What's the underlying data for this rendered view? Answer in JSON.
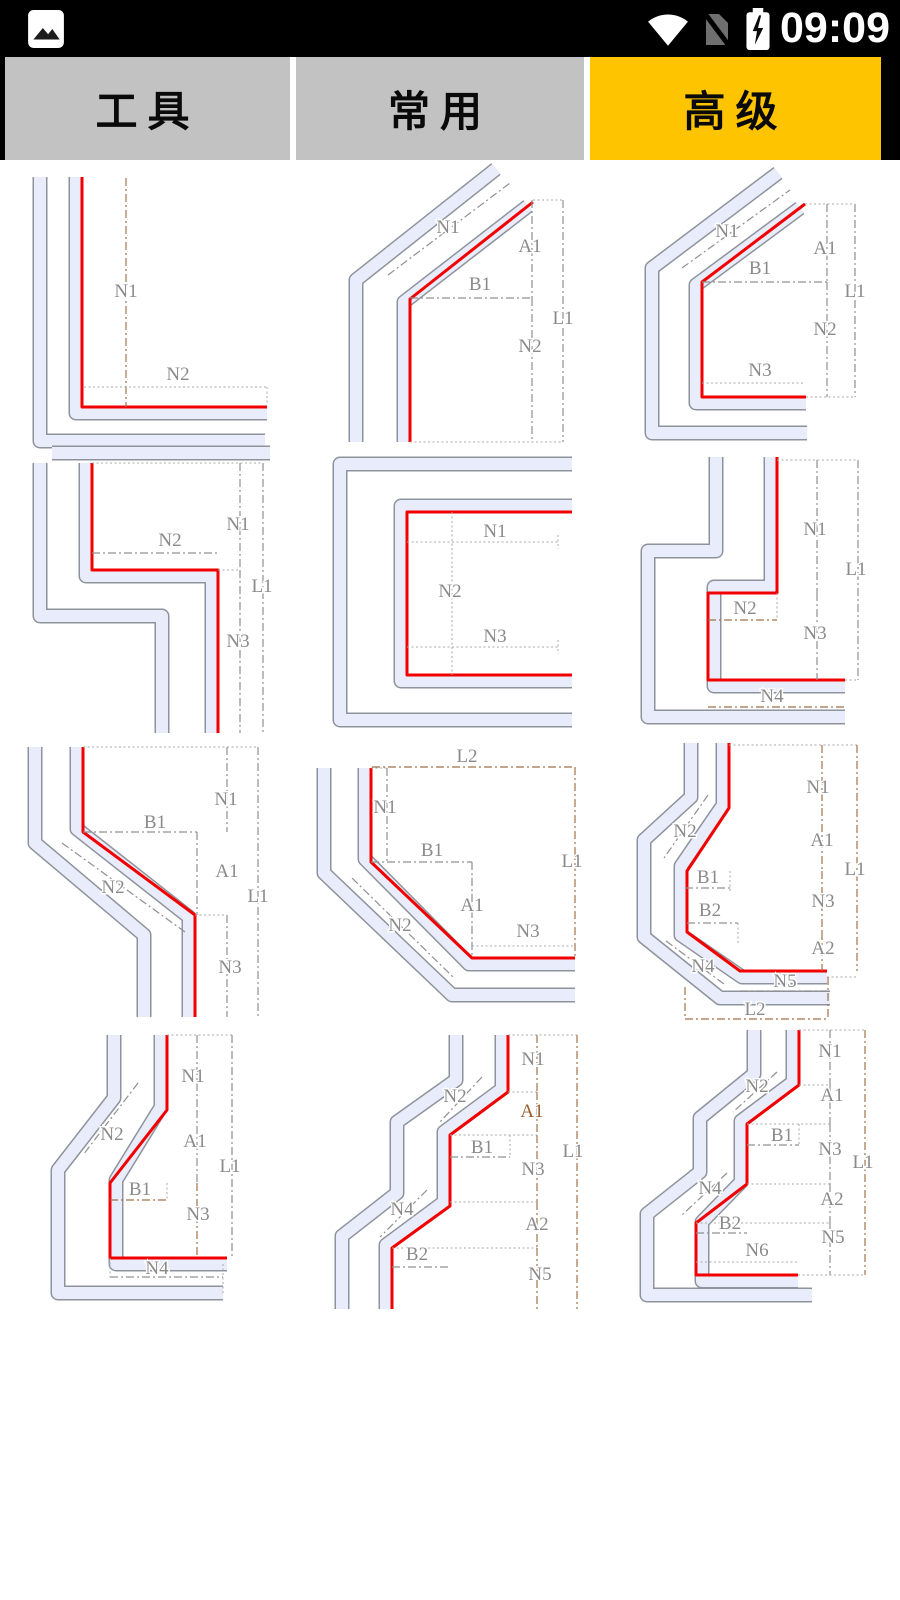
{
  "status_bar": {
    "time": "09:09",
    "icons": [
      "photo-icon",
      "wifi-icon",
      "no-sim-icon",
      "battery-charging-icon"
    ]
  },
  "tabs": [
    {
      "label": "工具",
      "active": false
    },
    {
      "label": "常用",
      "active": false
    },
    {
      "label": "高级",
      "active": true
    }
  ],
  "palette": {
    "gray": "#8a8a8a",
    "brown": "#9a5f30",
    "red": "#f20000",
    "sheet_fill": "#e9edfb",
    "sheet_outline": "#8e939b",
    "tab_active": "#ffc400",
    "tab_inactive": "#c2c2c2"
  },
  "diagrams": [
    {
      "labels": [
        {
          "t": "N1",
          "x": 126,
          "y": 137,
          "c": "gray"
        },
        {
          "t": "N2",
          "x": 178,
          "y": 220,
          "c": "gray"
        }
      ]
    },
    {
      "labels": [
        {
          "t": "N1",
          "x": 148,
          "y": 73,
          "c": "gray"
        },
        {
          "t": "A1",
          "x": 230,
          "y": 92,
          "c": "gray"
        },
        {
          "t": "B1",
          "x": 180,
          "y": 130,
          "c": "gray"
        },
        {
          "t": "L1",
          "x": 263,
          "y": 164,
          "c": "gray"
        },
        {
          "t": "N2",
          "x": 230,
          "y": 192,
          "c": "gray"
        }
      ]
    },
    {
      "labels": [
        {
          "t": "N1",
          "x": 127,
          "y": 77,
          "c": "gray"
        },
        {
          "t": "A1",
          "x": 225,
          "y": 94,
          "c": "gray"
        },
        {
          "t": "B1",
          "x": 160,
          "y": 114,
          "c": "gray"
        },
        {
          "t": "L1",
          "x": 255,
          "y": 137,
          "c": "gray"
        },
        {
          "t": "N2",
          "x": 225,
          "y": 175,
          "c": "gray"
        },
        {
          "t": "N3",
          "x": 160,
          "y": 216,
          "c": "gray"
        }
      ]
    },
    {
      "labels": [
        {
          "t": "N1",
          "x": 238,
          "y": 85,
          "c": "gray"
        },
        {
          "t": "N2",
          "x": 170,
          "y": 101,
          "c": "gray"
        },
        {
          "t": "L1",
          "x": 262,
          "y": 147,
          "c": "gray"
        },
        {
          "t": "N3",
          "x": 238,
          "y": 202,
          "c": "gray"
        }
      ]
    },
    {
      "labels": [
        {
          "t": "N1",
          "x": 195,
          "y": 92,
          "c": "gray"
        },
        {
          "t": "N2",
          "x": 150,
          "y": 152,
          "c": "gray"
        },
        {
          "t": "N3",
          "x": 195,
          "y": 197,
          "c": "gray"
        }
      ]
    },
    {
      "labels": [
        {
          "t": "N1",
          "x": 215,
          "y": 90,
          "c": "gray"
        },
        {
          "t": "L1",
          "x": 256,
          "y": 130,
          "c": "gray"
        },
        {
          "t": "N2",
          "x": 145,
          "y": 169,
          "c": "gray"
        },
        {
          "t": "N3",
          "x": 215,
          "y": 194,
          "c": "gray"
        },
        {
          "t": "N4",
          "x": 172,
          "y": 257,
          "c": "gray"
        }
      ]
    },
    {
      "labels": [
        {
          "t": "N1",
          "x": 226,
          "y": 80,
          "c": "gray"
        },
        {
          "t": "B1",
          "x": 155,
          "y": 103,
          "c": "gray"
        },
        {
          "t": "N2",
          "x": 113,
          "y": 168,
          "c": "gray"
        },
        {
          "t": "A1",
          "x": 227,
          "y": 152,
          "c": "gray"
        },
        {
          "t": "L1",
          "x": 258,
          "y": 177,
          "c": "gray"
        },
        {
          "t": "N3",
          "x": 230,
          "y": 248,
          "c": "gray"
        }
      ]
    },
    {
      "labels": [
        {
          "t": "L2",
          "x": 167,
          "y": 37,
          "c": "gray"
        },
        {
          "t": "N1",
          "x": 85,
          "y": 88,
          "c": "gray"
        },
        {
          "t": "B1",
          "x": 132,
          "y": 131,
          "c": "gray"
        },
        {
          "t": "N2",
          "x": 100,
          "y": 206,
          "c": "gray"
        },
        {
          "t": "A1",
          "x": 172,
          "y": 186,
          "c": "gray"
        },
        {
          "t": "L1",
          "x": 272,
          "y": 142,
          "c": "gray"
        },
        {
          "t": "N3",
          "x": 228,
          "y": 212,
          "c": "gray"
        }
      ]
    },
    {
      "labels": [
        {
          "t": "N1",
          "x": 218,
          "y": 68,
          "c": "gray"
        },
        {
          "t": "N2",
          "x": 85,
          "y": 112,
          "c": "gray"
        },
        {
          "t": "A1",
          "x": 222,
          "y": 121,
          "c": "gray"
        },
        {
          "t": "L1",
          "x": 255,
          "y": 150,
          "c": "gray"
        },
        {
          "t": "B1",
          "x": 108,
          "y": 158,
          "c": "gray"
        },
        {
          "t": "N3",
          "x": 223,
          "y": 182,
          "c": "gray"
        },
        {
          "t": "B2",
          "x": 110,
          "y": 191,
          "c": "gray"
        },
        {
          "t": "A2",
          "x": 223,
          "y": 229,
          "c": "gray"
        },
        {
          "t": "N4",
          "x": 103,
          "y": 247,
          "c": "gray"
        },
        {
          "t": "N5",
          "x": 185,
          "y": 262,
          "c": "gray"
        },
        {
          "t": "L2",
          "x": 155,
          "y": 290,
          "c": "gray"
        }
      ]
    },
    {
      "labels": [
        {
          "t": "N1",
          "x": 193,
          "y": 57,
          "c": "gray"
        },
        {
          "t": "N2",
          "x": 112,
          "y": 115,
          "c": "gray"
        },
        {
          "t": "A1",
          "x": 195,
          "y": 122,
          "c": "gray"
        },
        {
          "t": "L1",
          "x": 230,
          "y": 147,
          "c": "gray"
        },
        {
          "t": "B1",
          "x": 140,
          "y": 170,
          "c": "gray"
        },
        {
          "t": "N3",
          "x": 198,
          "y": 195,
          "c": "gray"
        },
        {
          "t": "N4",
          "x": 157,
          "y": 249,
          "c": "gray"
        }
      ]
    },
    {
      "labels": [
        {
          "t": "N1",
          "x": 233,
          "y": 40,
          "c": "gray"
        },
        {
          "t": "N2",
          "x": 155,
          "y": 77,
          "c": "gray"
        },
        {
          "t": "A1",
          "x": 232,
          "y": 92,
          "c": "brown"
        },
        {
          "t": "B1",
          "x": 182,
          "y": 128,
          "c": "gray"
        },
        {
          "t": "L1",
          "x": 273,
          "y": 132,
          "c": "gray"
        },
        {
          "t": "N3",
          "x": 233,
          "y": 150,
          "c": "gray"
        },
        {
          "t": "N4",
          "x": 102,
          "y": 190,
          "c": "gray"
        },
        {
          "t": "A2",
          "x": 237,
          "y": 205,
          "c": "gray"
        },
        {
          "t": "B2",
          "x": 117,
          "y": 235,
          "c": "gray"
        },
        {
          "t": "N5",
          "x": 240,
          "y": 255,
          "c": "gray"
        }
      ]
    },
    {
      "labels": [
        {
          "t": "N1",
          "x": 230,
          "y": 32,
          "c": "gray"
        },
        {
          "t": "N2",
          "x": 157,
          "y": 67,
          "c": "gray"
        },
        {
          "t": "A1",
          "x": 232,
          "y": 76,
          "c": "gray"
        },
        {
          "t": "B1",
          "x": 182,
          "y": 116,
          "c": "gray"
        },
        {
          "t": "N3",
          "x": 230,
          "y": 130,
          "c": "gray"
        },
        {
          "t": "L1",
          "x": 263,
          "y": 143,
          "c": "gray"
        },
        {
          "t": "N4",
          "x": 110,
          "y": 169,
          "c": "gray"
        },
        {
          "t": "A2",
          "x": 232,
          "y": 180,
          "c": "gray"
        },
        {
          "t": "B2",
          "x": 130,
          "y": 204,
          "c": "gray"
        },
        {
          "t": "N5",
          "x": 233,
          "y": 218,
          "c": "gray"
        },
        {
          "t": "N6",
          "x": 157,
          "y": 231,
          "c": "gray"
        }
      ]
    }
  ]
}
